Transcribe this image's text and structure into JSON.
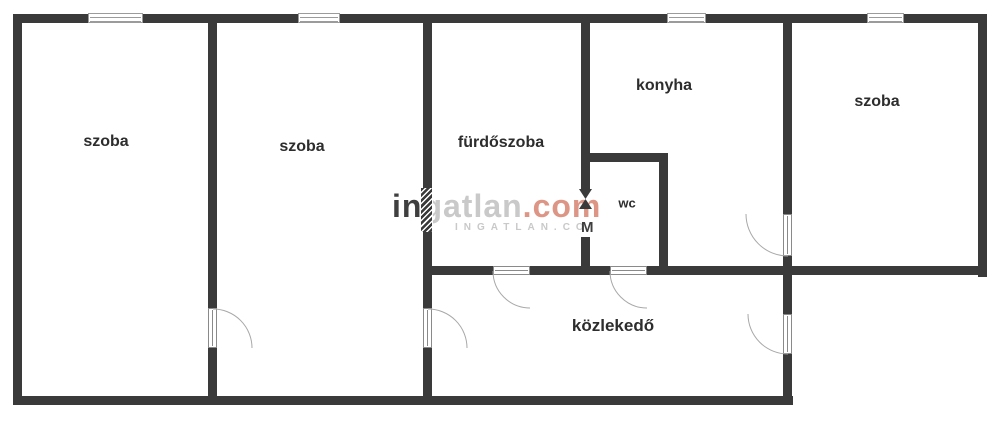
{
  "floorplan": {
    "rooms": {
      "szoba1": {
        "label": "szoba"
      },
      "szoba2": {
        "label": "szoba"
      },
      "furdoszoba": {
        "label": "fürdőszoba"
      },
      "konyha": {
        "label": "konyha"
      },
      "wc": {
        "label": "wc"
      },
      "szoba3": {
        "label": "szoba"
      },
      "kozlekedo": {
        "label": "közlekedő"
      }
    }
  },
  "watermark": {
    "line1": {
      "part1": "in",
      "part2": "gatlan",
      "part3": ".com"
    },
    "line2": {
      "part1": "INGATLAN.CO",
      "part2": "M"
    }
  },
  "colors": {
    "wall": "#3a3a3a",
    "label": "#2d2d2d",
    "door-line": "#a8a8a8",
    "frame-line": "#9b9b9b",
    "wm-dark": "#3f3f3f",
    "wm-light": "#c9c9c9",
    "wm-accent": "#dd9685",
    "bg": "#ffffff"
  }
}
